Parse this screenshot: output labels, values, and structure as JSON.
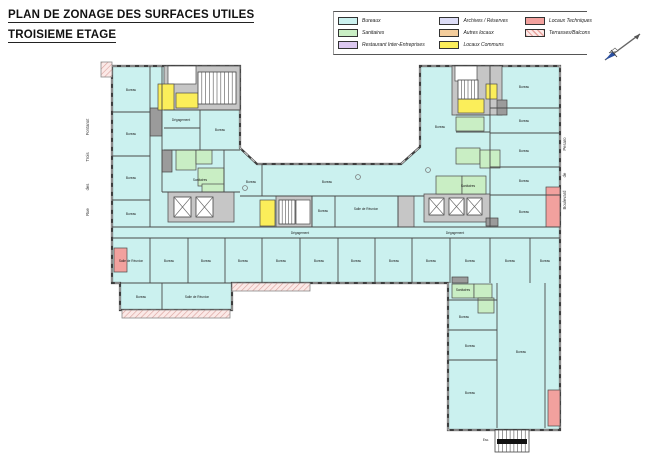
{
  "title": {
    "line1": "PLAN DE ZONAGE DES SURFACES UTILES",
    "line2": "TROISIEME ETAGE"
  },
  "colors": {
    "bureaux": "#CBF1EF",
    "sanitaires": "#C9EEC4",
    "restaurant": "#DCC8F0",
    "archives": "#DCDCF6",
    "autres": "#F4CD9C",
    "communs": "#FBEE5A",
    "techniques": "#F2A19E",
    "core": "#C6C6C6",
    "shaft": "#9B9B9B",
    "blanc": "#FFFFFF",
    "wall": "#3E3E3E",
    "label": "#1A1A1A"
  },
  "legend": {
    "columns": [
      [
        {
          "label": "Bureaux",
          "zone": "bureaux"
        },
        {
          "label": "Sanitaires",
          "zone": "sanitaires"
        },
        {
          "label": "Restaurant Inter-Entreprises",
          "zone": "restaurant"
        }
      ],
      [
        {
          "label": "Archives / Réserves",
          "zone": "archives"
        },
        {
          "label": "Autres locaux",
          "zone": "autres"
        },
        {
          "label": "Locaux Communs",
          "zone": "communs"
        }
      ],
      [
        {
          "label": "Locaux Techniques",
          "zone": "techniques"
        },
        {
          "label": "Terrasses/Balcons",
          "zone": "terrasses"
        }
      ]
    ]
  },
  "streets": {
    "left": {
      "x": 89,
      "words": [
        {
          "t": "Fontanot",
          "y": 127
        },
        {
          "t": "Trois",
          "y": 157
        },
        {
          "t": "des",
          "y": 187
        },
        {
          "t": "Rue",
          "y": 212
        }
      ]
    },
    "right": {
      "x": 566,
      "words": [
        {
          "t": "Pesaro",
          "y": 144
        },
        {
          "t": "de",
          "y": 175
        },
        {
          "t": "Boulevard",
          "y": 200
        }
      ]
    }
  },
  "plan": {
    "outline": "112,66 240,66 240,148 257,164 401,164 420,147 420,66 560,66 560,430 448,430 448,283 232,283 232,310 120,310 120,283 112,283",
    "terraces": [
      {
        "x": 232,
        "y": 283,
        "w": 78,
        "h": 8
      },
      {
        "x": 122,
        "y": 310,
        "w": 108,
        "h": 8
      },
      {
        "x": 101,
        "y": 62,
        "w": 11,
        "h": 15
      }
    ],
    "cores": [
      {
        "x": 164,
        "y": 66,
        "w": 76,
        "h": 44
      },
      {
        "x": 168,
        "y": 192,
        "w": 66,
        "h": 30
      },
      {
        "x": 452,
        "y": 66,
        "w": 50,
        "h": 49
      },
      {
        "x": 424,
        "y": 194,
        "w": 66,
        "h": 28
      },
      {
        "x": 276,
        "y": 196,
        "w": 36,
        "h": 31
      },
      {
        "x": 398,
        "y": 196,
        "w": 16,
        "h": 31
      }
    ],
    "shafts": [
      {
        "x": 150,
        "y": 108,
        "w": 12,
        "h": 28
      },
      {
        "x": 162,
        "y": 150,
        "w": 10,
        "h": 22
      },
      {
        "x": 497,
        "y": 100,
        "w": 10,
        "h": 15
      },
      {
        "x": 486,
        "y": 218,
        "w": 12,
        "h": 8
      },
      {
        "x": 452,
        "y": 277,
        "w": 16,
        "h": 6
      }
    ],
    "rooms": [
      {
        "zone": "blanc",
        "x": 168,
        "y": 66,
        "w": 28,
        "h": 18
      },
      {
        "zone": "blanc",
        "x": 455,
        "y": 66,
        "w": 22,
        "h": 15
      },
      {
        "zone": "blanc",
        "x": 296,
        "y": 200,
        "w": 14,
        "h": 24
      },
      {
        "zone": "communs",
        "x": 158,
        "y": 84,
        "w": 16,
        "h": 26
      },
      {
        "zone": "communs",
        "x": 176,
        "y": 93,
        "w": 22,
        "h": 15
      },
      {
        "zone": "communs",
        "x": 458,
        "y": 99,
        "w": 26,
        "h": 14
      },
      {
        "zone": "communs",
        "x": 486,
        "y": 84,
        "w": 11,
        "h": 15
      },
      {
        "zone": "communs",
        "x": 260,
        "y": 200,
        "w": 15,
        "h": 26
      },
      {
        "zone": "sanitaires",
        "x": 176,
        "y": 150,
        "w": 20,
        "h": 20
      },
      {
        "zone": "sanitaires",
        "x": 196,
        "y": 150,
        "w": 16,
        "h": 14
      },
      {
        "zone": "sanitaires",
        "x": 198,
        "y": 168,
        "w": 26,
        "h": 18
      },
      {
        "zone": "sanitaires",
        "x": 202,
        "y": 184,
        "w": 22,
        "h": 8
      },
      {
        "zone": "sanitaires",
        "x": 456,
        "y": 117,
        "w": 28,
        "h": 14
      },
      {
        "zone": "sanitaires",
        "x": 456,
        "y": 148,
        "w": 24,
        "h": 16
      },
      {
        "zone": "sanitaires",
        "x": 480,
        "y": 150,
        "w": 20,
        "h": 18
      },
      {
        "zone": "sanitaires",
        "x": 436,
        "y": 176,
        "w": 26,
        "h": 18
      },
      {
        "zone": "sanitaires",
        "x": 462,
        "y": 176,
        "w": 24,
        "h": 18
      },
      {
        "zone": "sanitaires",
        "x": 452,
        "y": 284,
        "w": 22,
        "h": 14
      },
      {
        "zone": "sanitaires",
        "x": 474,
        "y": 284,
        "w": 18,
        "h": 14
      },
      {
        "zone": "sanitaires",
        "x": 478,
        "y": 298,
        "w": 16,
        "h": 15
      },
      {
        "zone": "techniques",
        "x": 546,
        "y": 187,
        "w": 14,
        "h": 40
      },
      {
        "zone": "techniques",
        "x": 114,
        "y": 248,
        "w": 13,
        "h": 24
      },
      {
        "zone": "techniques",
        "x": 548,
        "y": 390,
        "w": 12,
        "h": 36
      }
    ],
    "stairs": [
      {
        "x": 198,
        "y": 72,
        "w": 38,
        "h": 32,
        "n": 10
      },
      {
        "x": 458,
        "y": 80,
        "w": 20,
        "h": 19,
        "n": 6
      },
      {
        "x": 279,
        "y": 200,
        "w": 16,
        "h": 24,
        "n": 5
      }
    ],
    "ext_stair": {
      "x": 495,
      "y": 430,
      "w": 34,
      "h": 22,
      "n": 9,
      "landing": {
        "x": 497,
        "y": 439,
        "w": 30,
        "h": 5
      }
    },
    "elevators": [
      {
        "x": 174,
        "y": 197,
        "w": 17,
        "h": 20
      },
      {
        "x": 196,
        "y": 197,
        "w": 17,
        "h": 20
      },
      {
        "x": 429,
        "y": 198,
        "w": 15,
        "h": 17
      },
      {
        "x": 449,
        "y": 198,
        "w": 15,
        "h": 17
      },
      {
        "x": 467,
        "y": 198,
        "w": 15,
        "h": 17
      }
    ],
    "walls": [
      [
        150,
        66,
        150,
        227
      ],
      [
        162,
        66,
        162,
        192
      ],
      [
        112,
        112,
        150,
        112
      ],
      [
        112,
        156,
        150,
        156
      ],
      [
        112,
        200,
        150,
        200
      ],
      [
        164,
        110,
        240,
        110
      ],
      [
        164,
        128,
        200,
        128
      ],
      [
        200,
        110,
        200,
        150
      ],
      [
        164,
        150,
        240,
        150
      ],
      [
        224,
        150,
        224,
        192
      ],
      [
        162,
        192,
        240,
        192
      ],
      [
        262,
        164,
        262,
        196
      ],
      [
        240,
        196,
        424,
        196
      ],
      [
        312,
        196,
        312,
        227
      ],
      [
        335,
        196,
        335,
        227
      ],
      [
        398,
        196,
        398,
        227
      ],
      [
        112,
        227,
        560,
        227
      ],
      [
        112,
        238,
        560,
        238
      ],
      [
        150,
        238,
        150,
        283
      ],
      [
        188,
        238,
        188,
        283
      ],
      [
        225,
        238,
        225,
        283
      ],
      [
        262,
        238,
        262,
        283
      ],
      [
        300,
        238,
        300,
        283
      ],
      [
        338,
        238,
        338,
        283
      ],
      [
        375,
        238,
        375,
        283
      ],
      [
        412,
        238,
        412,
        283
      ],
      [
        450,
        238,
        450,
        283
      ],
      [
        490,
        238,
        490,
        283
      ],
      [
        530,
        238,
        530,
        283
      ],
      [
        490,
        66,
        490,
        227
      ],
      [
        490,
        108,
        560,
        108
      ],
      [
        490,
        133,
        560,
        133
      ],
      [
        490,
        167,
        560,
        167
      ],
      [
        490,
        195,
        560,
        195
      ],
      [
        456,
        115,
        490,
        115
      ],
      [
        456,
        132,
        490,
        132
      ],
      [
        497,
        283,
        497,
        428
      ],
      [
        545,
        283,
        545,
        428
      ],
      [
        448,
        300,
        497,
        300
      ],
      [
        448,
        330,
        497,
        330
      ],
      [
        448,
        360,
        497,
        360
      ],
      [
        162,
        283,
        162,
        310
      ],
      [
        120,
        283,
        232,
        283
      ]
    ],
    "circles": [
      [
        358,
        177
      ],
      [
        428,
        170
      ],
      [
        245,
        188
      ]
    ],
    "labels": [
      {
        "t": "Bureau",
        "x": 131,
        "y": 91
      },
      {
        "t": "Bureau",
        "x": 131,
        "y": 135
      },
      {
        "t": "Bureau",
        "x": 131,
        "y": 179
      },
      {
        "t": "Bureau",
        "x": 131,
        "y": 215
      },
      {
        "t": "Bureau",
        "x": 220,
        "y": 131
      },
      {
        "t": "Dégagement",
        "x": 181,
        "y": 121
      },
      {
        "t": "Sanitaires",
        "x": 200,
        "y": 181
      },
      {
        "t": "Bureau",
        "x": 251,
        "y": 183
      },
      {
        "t": "Bureau",
        "x": 327,
        "y": 183
      },
      {
        "t": "Bureau",
        "x": 323,
        "y": 212
      },
      {
        "t": "Salle de Réunion",
        "x": 366,
        "y": 210
      },
      {
        "t": "Dégagement",
        "x": 300,
        "y": 234
      },
      {
        "t": "Dégagement",
        "x": 455,
        "y": 234
      },
      {
        "t": "Salle de Réunion",
        "x": 131,
        "y": 262
      },
      {
        "t": "Bureau",
        "x": 169,
        "y": 262
      },
      {
        "t": "Bureau",
        "x": 206,
        "y": 262
      },
      {
        "t": "Bureau",
        "x": 243,
        "y": 262
      },
      {
        "t": "Bureau",
        "x": 281,
        "y": 262
      },
      {
        "t": "Bureau",
        "x": 319,
        "y": 262
      },
      {
        "t": "Bureau",
        "x": 356,
        "y": 262
      },
      {
        "t": "Bureau",
        "x": 394,
        "y": 262
      },
      {
        "t": "Bureau",
        "x": 431,
        "y": 262
      },
      {
        "t": "Bureau",
        "x": 470,
        "y": 262
      },
      {
        "t": "Bureau",
        "x": 510,
        "y": 262
      },
      {
        "t": "Bureau",
        "x": 545,
        "y": 262
      },
      {
        "t": "Bureau",
        "x": 141,
        "y": 298
      },
      {
        "t": "Salle de Réunion",
        "x": 197,
        "y": 298
      },
      {
        "t": "Bureau",
        "x": 440,
        "y": 128
      },
      {
        "t": "Bureau",
        "x": 524,
        "y": 88
      },
      {
        "t": "Bureau",
        "x": 524,
        "y": 122
      },
      {
        "t": "Bureau",
        "x": 524,
        "y": 152
      },
      {
        "t": "Bureau",
        "x": 524,
        "y": 182
      },
      {
        "t": "Bureau",
        "x": 524,
        "y": 213
      },
      {
        "t": "Sanitaires",
        "x": 468,
        "y": 187
      },
      {
        "t": "Sanitaires",
        "x": 463,
        "y": 291
      },
      {
        "t": "Bureau",
        "x": 464,
        "y": 318
      },
      {
        "t": "Bureau",
        "x": 470,
        "y": 347
      },
      {
        "t": "Bureau",
        "x": 521,
        "y": 353
      },
      {
        "t": "Bureau",
        "x": 470,
        "y": 394
      },
      {
        "t": "Esc.",
        "x": 486,
        "y": 441
      }
    ]
  }
}
